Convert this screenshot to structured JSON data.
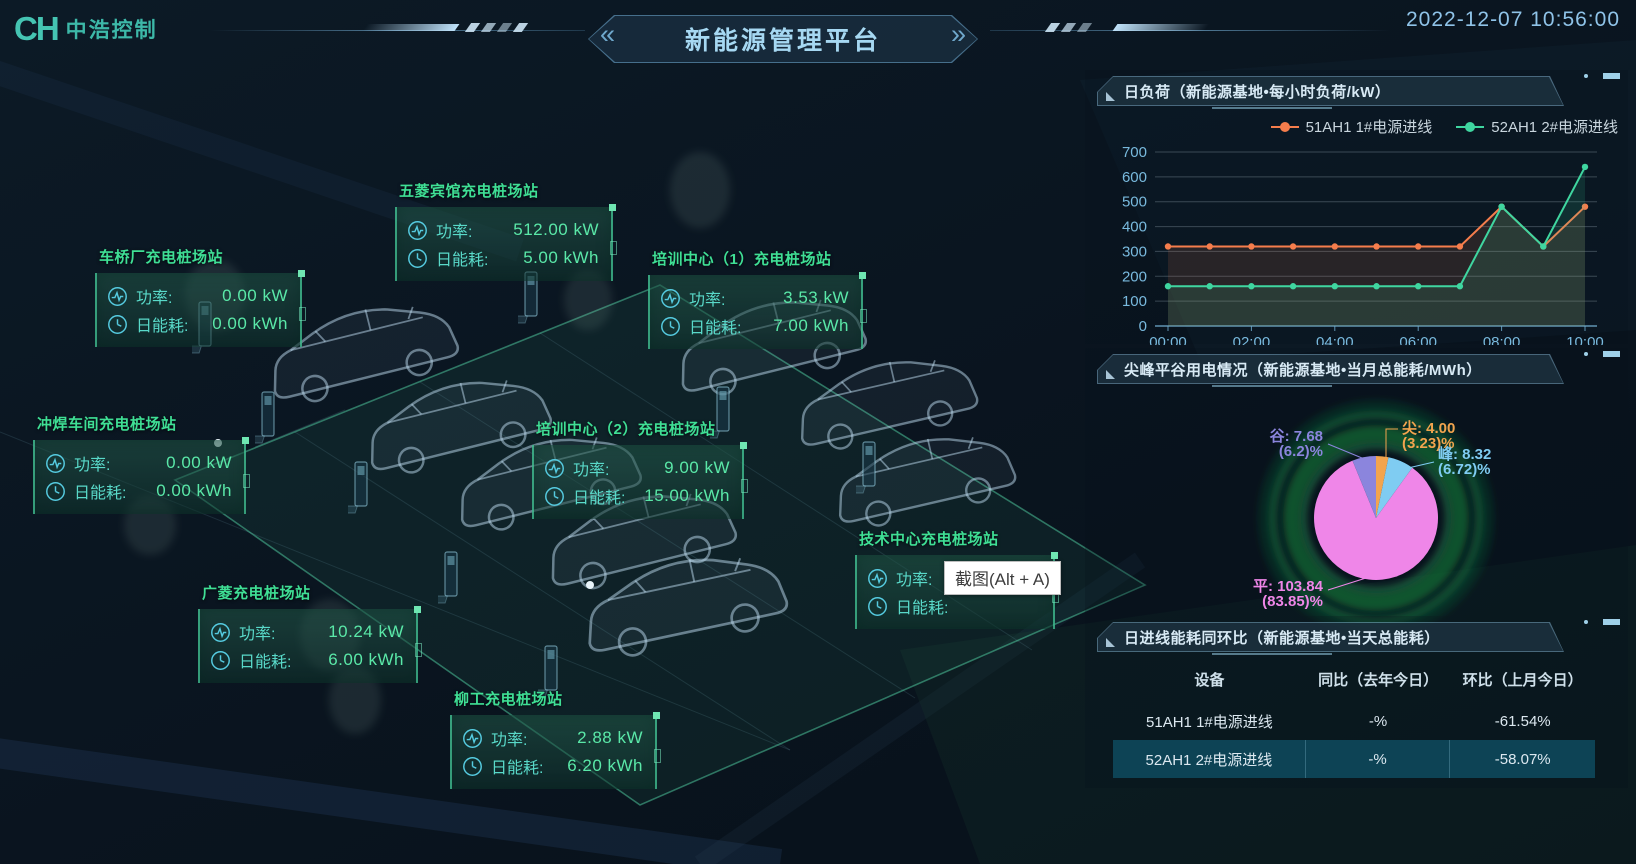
{
  "header": {
    "logo_mark": "CH",
    "logo_text": "中浩控制",
    "title": "新能源管理平台",
    "datetime": "2022-12-07 10:56:00"
  },
  "labels": {
    "power": "功率:",
    "energy": "日能耗:"
  },
  "stations": [
    {
      "name": "车桥厂充电桩场站",
      "power": "0.00 kW",
      "energy": "0.00 kWh"
    },
    {
      "name": "五菱宾馆充电桩场站",
      "power": "512.00 kW",
      "energy": "5.00 kWh"
    },
    {
      "name": "培训中心（1）充电桩场站",
      "power": "3.53 kW",
      "energy": "7.00 kWh"
    },
    {
      "name": "冲焊车间充电桩场站",
      "power": "0.00 kW",
      "energy": "0.00 kWh"
    },
    {
      "name": "培训中心（2）充电桩场站",
      "power": "9.00 kW",
      "energy": "15.00 kWh"
    },
    {
      "name": "技术中心充电桩场站",
      "power": "13.88 kW",
      "energy": ""
    },
    {
      "name": "广菱充电桩场站",
      "power": "10.24 kW",
      "energy": "6.00 kWh"
    },
    {
      "name": "柳工充电桩场站",
      "power": "2.88 kW",
      "energy": "6.20 kWh"
    }
  ],
  "tooltip": "截图(Alt + A)",
  "panels": {
    "load": {
      "title": "日负荷（新能源基地•每小时负荷/kW）"
    },
    "pie": {
      "title": "尖峰平谷用电情况（新能源基地•当月总能耗/MWh）"
    },
    "compare": {
      "title": "日进线能耗同环比（新能源基地•当天总能耗）"
    }
  },
  "chart_data": [
    {
      "type": "line",
      "title": "日负荷（新能源基地•每小时负荷/kW）",
      "x": [
        "00:00",
        "01:00",
        "02:00",
        "03:00",
        "04:00",
        "05:00",
        "06:00",
        "07:00",
        "08:00",
        "09:00",
        "10:00"
      ],
      "series": [
        {
          "name": "51AH1 1#电源进线",
          "color": "#f57d4c",
          "values": [
            320,
            320,
            320,
            320,
            320,
            320,
            320,
            320,
            480,
            320,
            480
          ]
        },
        {
          "name": "52AH1 2#电源进线",
          "color": "#3fd6a0",
          "values": [
            160,
            160,
            160,
            160,
            160,
            160,
            160,
            160,
            480,
            320,
            640
          ]
        }
      ],
      "xlabel": "",
      "ylabel": "kW",
      "ylim": [
        0,
        700
      ],
      "y_ticks": [
        0,
        100,
        200,
        300,
        400,
        500,
        600,
        700
      ],
      "grid": true,
      "legend_position": "top-right"
    },
    {
      "type": "pie",
      "title": "尖峰平谷用电情况（新能源基地•当月总能耗/MWh）",
      "slices": [
        {
          "name": "尖",
          "value": 4.0,
          "percent": "3.23",
          "color": "#f2a44e"
        },
        {
          "name": "峰",
          "value": 8.32,
          "percent": "6.72",
          "color": "#7fccf2"
        },
        {
          "name": "平",
          "value": 103.84,
          "percent": "83.85",
          "color": "#ef86e8"
        },
        {
          "name": "谷",
          "value": 7.68,
          "percent": "6.2",
          "color": "#8b85dd"
        }
      ]
    },
    {
      "type": "table",
      "title": "日进线能耗同环比（新能源基地•当天总能耗）",
      "headers": [
        "设备",
        "同比（去年今日）",
        "环比（上月今日）"
      ],
      "rows": [
        [
          "51AH1 1#电源进线",
          "-%",
          "-61.54%"
        ],
        [
          "52AH1 2#电源进线",
          "-%",
          "-58.07%"
        ]
      ]
    }
  ]
}
